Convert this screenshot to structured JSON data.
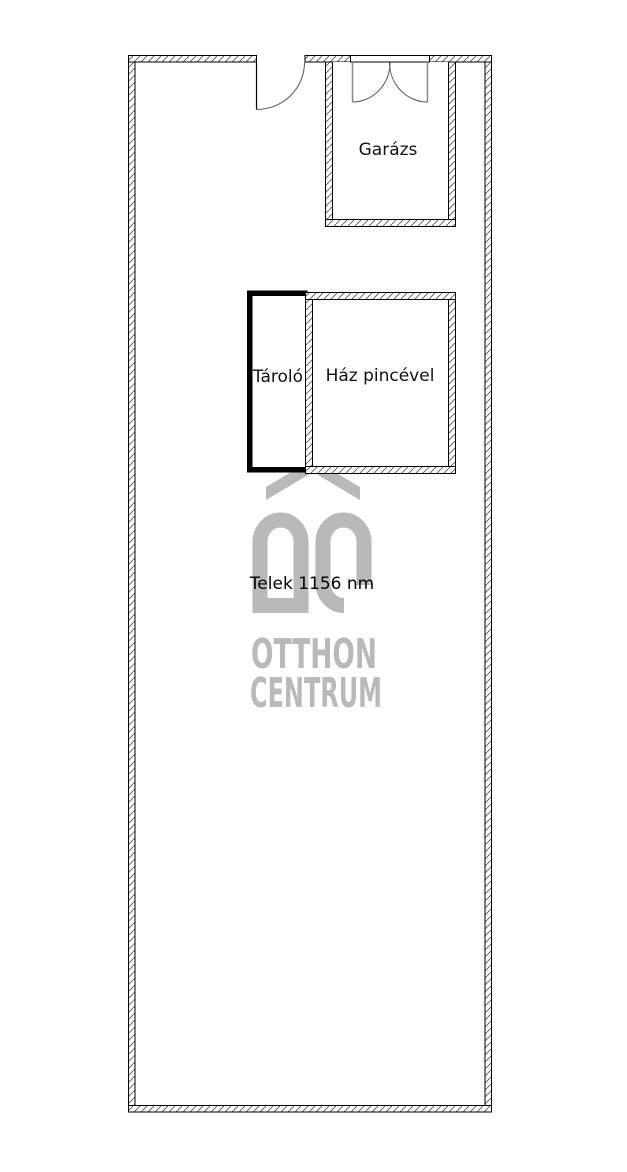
{
  "floorplan": {
    "rooms": [
      {
        "id": "garazs",
        "label": "Garázs"
      },
      {
        "id": "tarolo",
        "label": "Tároló"
      },
      {
        "id": "haz-pincevel",
        "label": "Ház pincével"
      }
    ],
    "plot": {
      "label": "Telek 1156 nm"
    },
    "colors": {
      "wall_line": "#000000",
      "hatch": "#555555",
      "solid_wall": "#000000",
      "door_leaf": "#8a8a8a",
      "background": "#ffffff"
    }
  },
  "watermark": {
    "logo_monogram": "OC",
    "brand_line1": "OTTHON",
    "brand_line2": "CENTRUM",
    "color": "#b9b9b9"
  }
}
